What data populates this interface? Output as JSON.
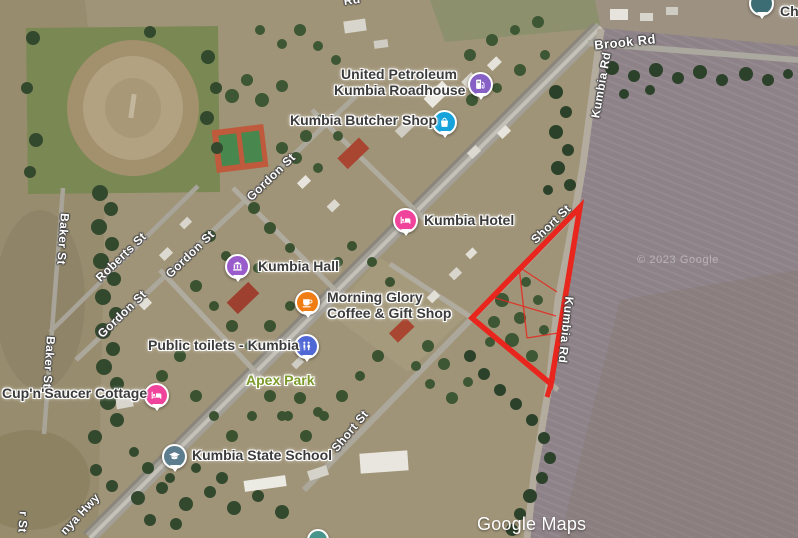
{
  "map": {
    "type": "satellite",
    "town": "Kumbia",
    "colors": {
      "parcel_outline": "#e8261d",
      "poi_label": "#3b3b3b",
      "street_label": "#ffffff",
      "park_label": "#7d9a2b",
      "field_east": "#8d8287",
      "field_west": "#978c6d"
    }
  },
  "watermarks": {
    "brand": "Google Maps",
    "copyright": "© 2023 Google"
  },
  "pois": [
    {
      "label": "United Petroleum Kumbia Roadhouse",
      "line1": "United Petroleum",
      "line2": "Kumbia Roadhouse",
      "icon": "fuel-pump-icon",
      "pin_color": "#8660c5"
    },
    {
      "label": "Kumbia Butcher Shop",
      "icon": "shopping-bag-icon",
      "pin_color": "#16a3dc"
    },
    {
      "label": "Kumbia Hotel",
      "icon": "bed-icon",
      "pin_color": "#f0449c"
    },
    {
      "label": "Kumbia Hall",
      "icon": "civic-building-icon",
      "pin_color": "#9a5bcb"
    },
    {
      "label": "Morning Glory Coffee & Gift Shop",
      "line1": "Morning Glory",
      "line2": "Coffee & Gift Shop",
      "icon": "coffee-cup-icon",
      "pin_color": "#f07d13"
    },
    {
      "label": "Public toilets - Kumbia",
      "icon": "restroom-icon",
      "pin_color": "#5067d6"
    },
    {
      "label": "Cup'n'Saucer Cottage",
      "icon": "bed-icon",
      "pin_color": "#f0449c"
    },
    {
      "label": "Kumbia State School",
      "icon": "graduation-cap-icon",
      "pin_color": "#5c7d8e"
    },
    {
      "label": "Ch",
      "icon": "map-pin-icon",
      "pin_color": "#3d6d74"
    }
  ],
  "park": {
    "label": "Apex Park"
  },
  "streets": [
    {
      "name": "Brook Rd"
    },
    {
      "name": "Kumbia Rd"
    },
    {
      "name": "Kumbia Rd"
    },
    {
      "name": "Short St"
    },
    {
      "name": "Short St"
    },
    {
      "name": "Gordon St"
    },
    {
      "name": "Gordon St"
    },
    {
      "name": "Gordon St"
    },
    {
      "name": "Roberts St"
    },
    {
      "name": "Baker St"
    },
    {
      "name": "Baker St"
    },
    {
      "name": "nya Hwy"
    },
    {
      "name": "r St"
    },
    {
      "name": "Rd"
    }
  ],
  "parcel": {
    "outline_color": "#e8261d",
    "vertices": [
      [
        580,
        207
      ],
      [
        551,
        384
      ],
      [
        472,
        318
      ]
    ],
    "inner_lines": [
      [
        [
          519,
          267
        ],
        [
          527,
          338
        ]
      ],
      [
        [
          519,
          267
        ],
        [
          557,
          292
        ]
      ],
      [
        [
          492,
          297
        ],
        [
          556,
          316
        ]
      ],
      [
        [
          527,
          338
        ],
        [
          558,
          333
        ]
      ]
    ]
  }
}
